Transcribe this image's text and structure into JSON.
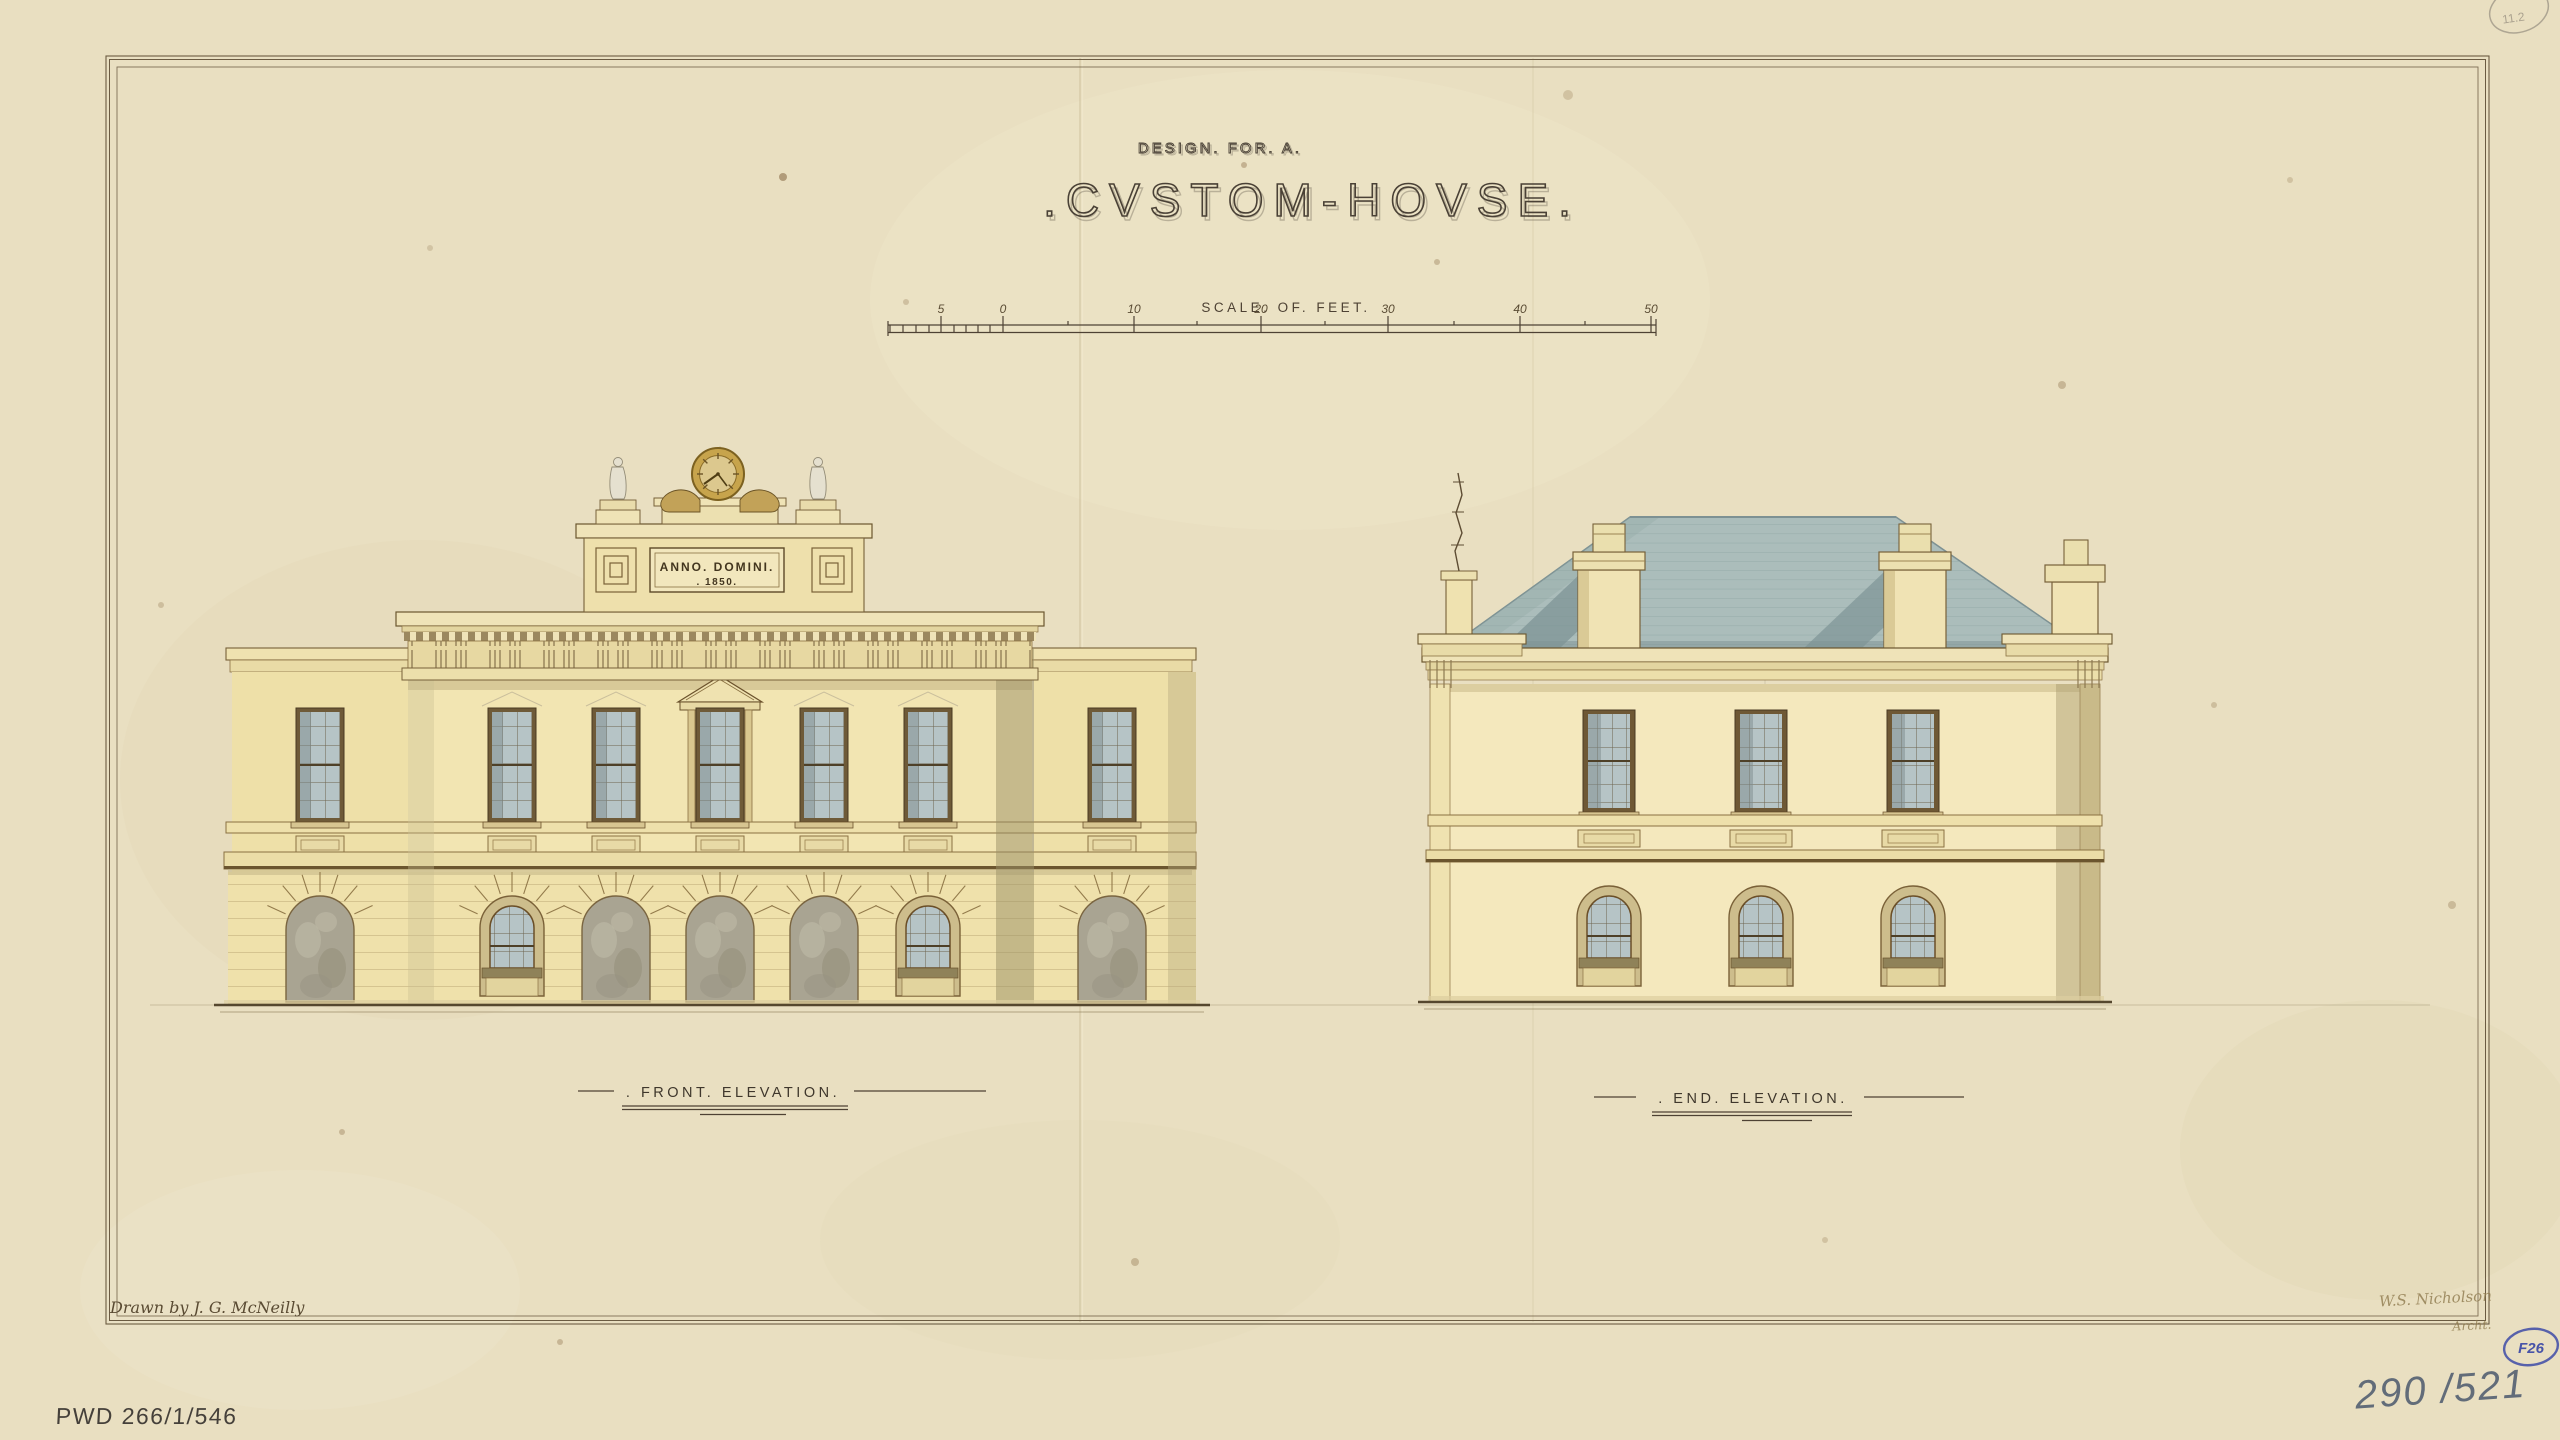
{
  "titles": {
    "line1": "DESIGN. FOR. A.",
    "line2": ".CVSTOM-HOVSE."
  },
  "scale_bar": {
    "label": "SCALE. OF. FEET.",
    "ticks": [
      "5",
      "0",
      "10",
      "20",
      "30",
      "40",
      "50"
    ]
  },
  "front_elevation": {
    "label": ". FRONT. ELEVATION.",
    "plaque_line1": "ANNO. DOMINI.",
    "plaque_line2": ". 1850."
  },
  "end_elevation": {
    "label": ". END. ELEVATION."
  },
  "annotations": {
    "drawn_by": "Drawn by J. G. McNeilly",
    "signature_line1": "W.S. Nicholson",
    "signature_line2": "Archt.",
    "archive_ref": "PWD 266/1/546",
    "catalog_number": "290 /521",
    "stamp": "F26",
    "corner_mark": "11.2"
  },
  "colors": {
    "paper": "#e9dfc1",
    "ink": "#4e4234",
    "line_brown": "#7a6138",
    "wall_cream": "#f2e5b2",
    "wall_end": "#f4e8bd",
    "roof_slate": "#abbdbb",
    "glass_blue": "#b6c4c6",
    "shadow_olive": "#9a8f66",
    "stamp_blue": "#4753a8",
    "pencil_grey": "#626c79",
    "clock_gold": "#c7a44c"
  }
}
